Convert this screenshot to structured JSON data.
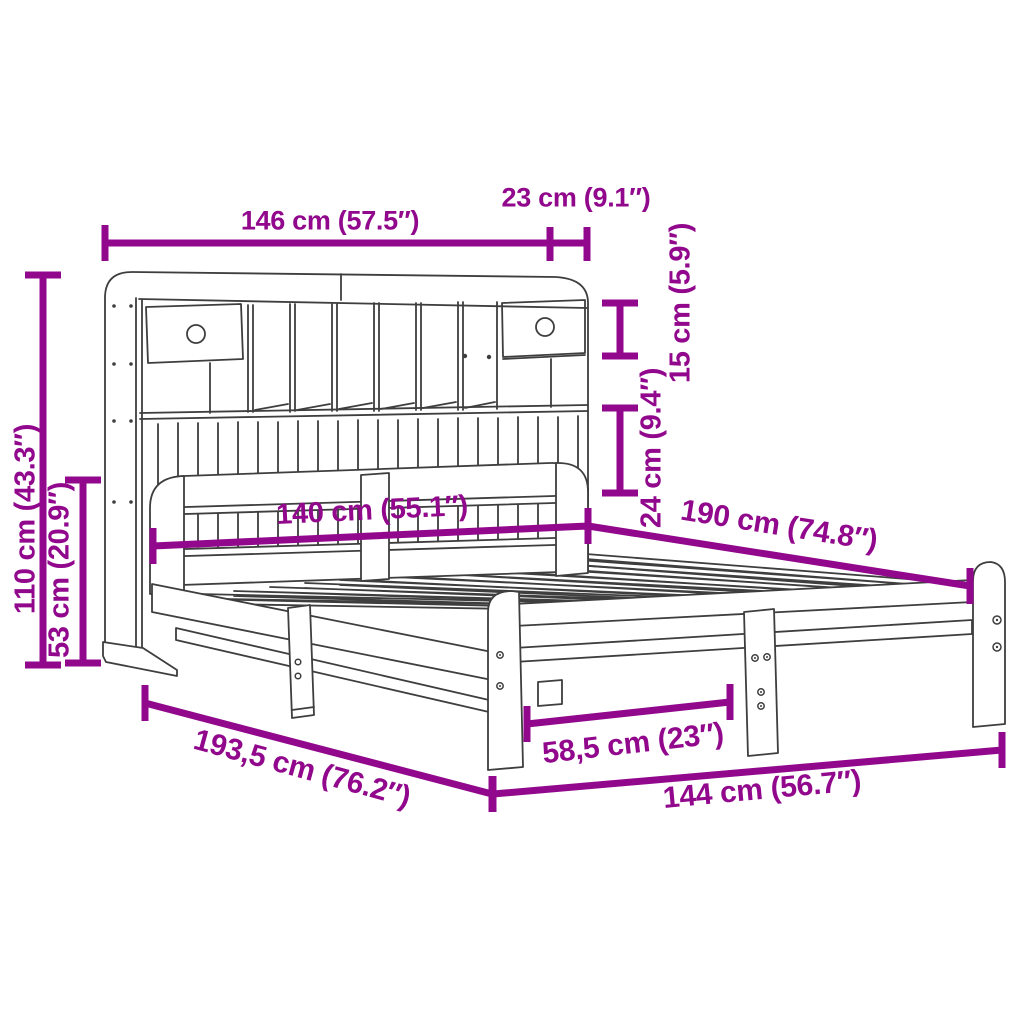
{
  "diagram": {
    "subject": "bed frame with bookcase headboard - dimension drawing",
    "colors": {
      "dimension_accent": "#91088C",
      "drawing_line": "#3E3E3E",
      "background": "#FFFFFF"
    },
    "labels": {
      "total_width": "146 cm (57.5″)",
      "headboard_depth": "23 cm (9.1″)",
      "upper_shelf_height": "15 cm (5.9″)",
      "lower_shelf_height": "24 cm (9.4″)",
      "total_height": "110 cm (43.3″)",
      "frame_height": "53 cm (20.9″)",
      "mattress_width": "140 cm (55.1″)",
      "mattress_length": "190 cm (74.8″)",
      "total_length": "193,5 cm (76.2″)",
      "leg_spacing": "58,5 cm (23″)",
      "frame_width": "144 cm (56.7″)"
    }
  }
}
